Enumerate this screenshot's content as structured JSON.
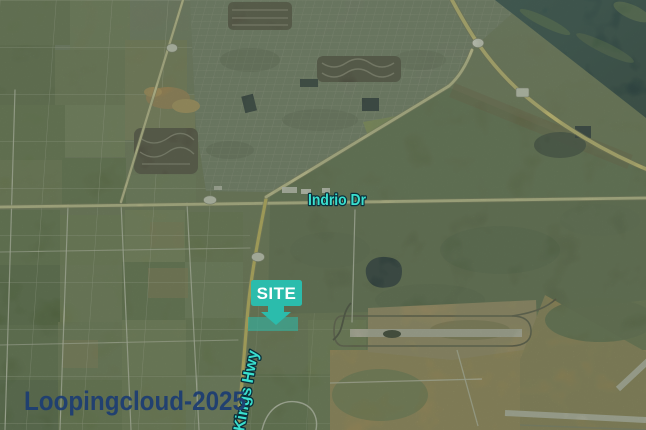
{
  "map": {
    "description": "Oblique aerial photo site exhibit",
    "labels": {
      "indrio_road": "Indrio Dr",
      "kings_highway": "Kings Hwy",
      "site_marker": "SITE",
      "watermark": "Loopingcloud-2025"
    },
    "colors": {
      "map_label_teal": "#3ADFCE",
      "map_label_outline": "#0B2F3A",
      "site_box_teal": "#2BBCAC",
      "site_text": "#FFFFFF",
      "watermark_navy": "#1E3E72",
      "water_dark_teal": "#16343E",
      "highway_yellow": "#E9D98E",
      "airport_tan": "#A98F58"
    },
    "features": {
      "water_body": "lagoon upper right",
      "airport": "runways lower right",
      "farmland": "field grid left side",
      "residential": "street grid upper center",
      "site_parcel": "teal highlighted parcel under arrow",
      "road_shields": "blank white oval route shields on roads"
    }
  }
}
